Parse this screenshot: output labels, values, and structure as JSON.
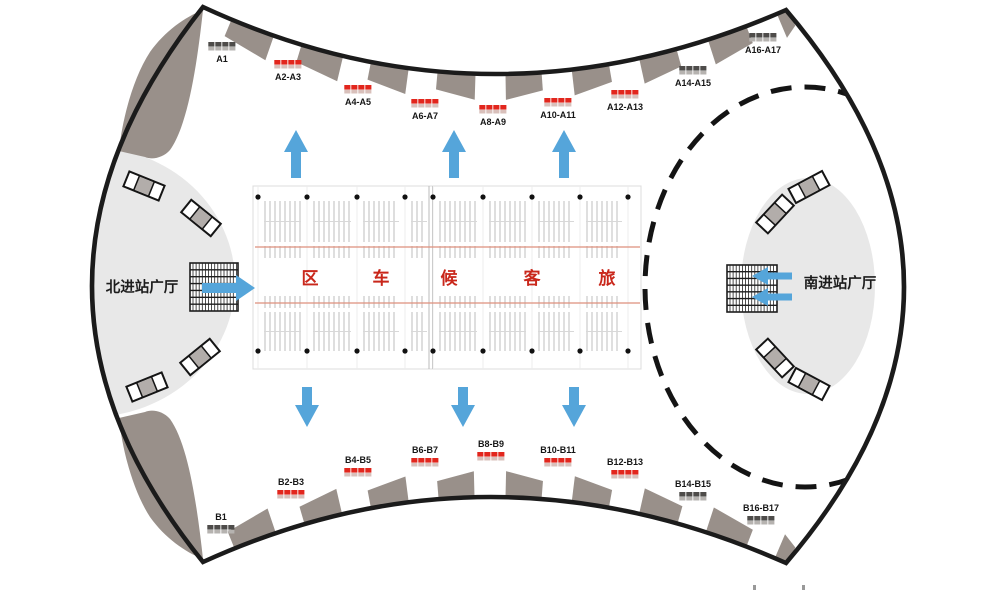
{
  "map": {
    "halls": {
      "north": {
        "label": "北进站广厅"
      },
      "south": {
        "label": "南进站广厅"
      }
    },
    "waiting_area": {
      "chars": [
        "区",
        "车",
        "候",
        "客",
        "旅"
      ]
    },
    "gates": {
      "top": [
        {
          "label": "A1",
          "marker": "gray"
        },
        {
          "label": "A2-A3",
          "marker": "red"
        },
        {
          "label": "A4-A5",
          "marker": "red"
        },
        {
          "label": "A6-A7",
          "marker": "red"
        },
        {
          "label": "A8-A9",
          "marker": "red"
        },
        {
          "label": "A10-A11",
          "marker": "red"
        },
        {
          "label": "A12-A13",
          "marker": "red"
        },
        {
          "label": "A14-A15",
          "marker": "gray"
        },
        {
          "label": "A16-A17",
          "marker": "gray"
        }
      ],
      "bottom": [
        {
          "label": "B1",
          "marker": "gray"
        },
        {
          "label": "B2-B3",
          "marker": "red"
        },
        {
          "label": "B4-B5",
          "marker": "red"
        },
        {
          "label": "B6-B7",
          "marker": "red"
        },
        {
          "label": "B8-B9",
          "marker": "red"
        },
        {
          "label": "B10-B11",
          "marker": "red"
        },
        {
          "label": "B12-B13",
          "marker": "red"
        },
        {
          "label": "B14-B15",
          "marker": "gray"
        },
        {
          "label": "B16-B17",
          "marker": "gray"
        }
      ]
    },
    "flow_arrows": {
      "up_count": 3,
      "down_count": 3,
      "north_entry_direction": "right",
      "south_entry_direction": "left",
      "south_entry_count": 2
    },
    "colors": {
      "outline": "#1b1b1b",
      "structure_gray": "#99908a",
      "hall_fill": "#e8e8e8",
      "gate_red": "#e2261d",
      "gate_red_base": "#d9c0bb",
      "gate_gray": "#4e4c4a",
      "gate_gray_base": "#b6b3b0",
      "arrow_blue": "#55a5da",
      "seat_stripe": "#c9c9c9",
      "aisle_line": "#de8f7c",
      "waiting_text_red": "#c9271b",
      "escalator_gray": "#b2adaa",
      "label_text": "#161616"
    }
  }
}
